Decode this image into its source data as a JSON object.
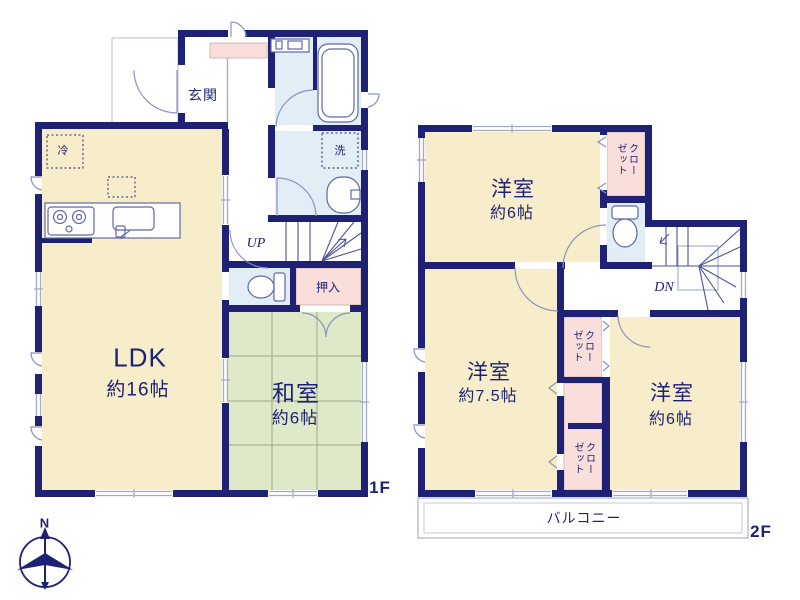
{
  "colors": {
    "wall_navy": "#1f2274",
    "room_cream": "#f8edca",
    "tatami_green": "#dde9c8",
    "closet_pink": "#fadedc",
    "wet_area_blue": "#e2eef6",
    "fixture_line": "#5f69a5",
    "window_line": "#a3abc7",
    "tatami_line": "#a9b493",
    "text_navy": "#1f2274"
  },
  "floor1": {
    "floor_label": "1F",
    "entrance_label": "玄関",
    "fridge_label": "冷",
    "laundry_label": "洗",
    "stairs_label": "UP",
    "closet_label": "押入",
    "ldk_label": "LDK",
    "ldk_size": "約16帖",
    "tatami_label": "和室",
    "tatami_size": "約6帖"
  },
  "floor2": {
    "floor_label": "2F",
    "bedroom_north_label": "洋室",
    "bedroom_north_size": "約6帖",
    "bedroom_west_label": "洋室",
    "bedroom_west_size": "約7.5帖",
    "bedroom_east_label": "洋室",
    "bedroom_east_size": "約6帖",
    "closet_north_label": "クローゼット",
    "closet_mid_label": "クローゼット",
    "closet_south_label": "クローゼット",
    "stairs_label": "DN",
    "balcony_label": "バルコニー"
  },
  "compass": {
    "north_label": "N"
  }
}
